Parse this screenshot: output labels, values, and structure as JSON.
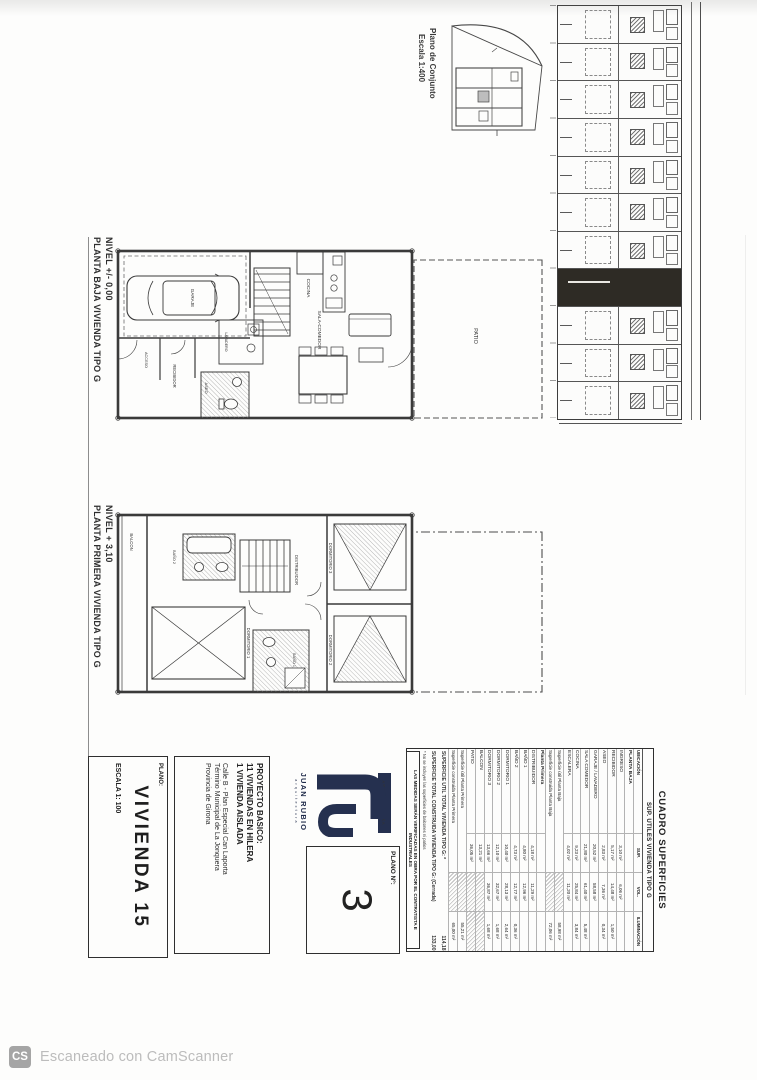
{
  "scan": {
    "footer_badge": "CS",
    "footer_text": "Escaneado con CamScanner"
  },
  "site_overview": {
    "caption_line1": "Plano de Conjunto",
    "caption_line2": "Escala 1:400"
  },
  "site_strip": {
    "unit_count": 11,
    "highlighted_unit_index": 7
  },
  "plans": [
    {
      "caption_line1": "NIVEL +/- 0,00",
      "caption_line2": "PLANTA BAJA VIVIENDA TIPO G",
      "labels": {
        "patio": "PATIO",
        "garaje": "GARAJE",
        "lavadero": "LAVADERO",
        "cocina": "COCINA",
        "sala_comedor": "SALA-COMEDOR",
        "aseo": "ASEO",
        "recibidor": "RECIBIDOR",
        "acceso": "ACCESO"
      }
    },
    {
      "caption_line1": "NIVEL + 3,10",
      "caption_line2": "PLANTA PRIMERA VIVIENDA TIPO G",
      "labels": {
        "balcon": "BALCON",
        "dormitorio1": "DORMITORIO 1",
        "dormitorio2": "DORMITORIO 2",
        "dormitorio3": "DORMITORIO 3",
        "bano1": "BAÑO 1",
        "bano2": "BAÑO 2",
        "distribuidor": "DISTRIBUIDOR"
      }
    }
  ],
  "title_block": {
    "logo": {
      "band": "ARQUITECTURA",
      "name": "JUAN RUBIO",
      "sub": "arquitectura"
    },
    "plano_num": {
      "label": "PLANO Nº:",
      "value": "3"
    },
    "project": {
      "heading": "PROYECTO BASICO:",
      "lines": [
        "11 VIVIENDAS EN HILERA",
        "1 VIVIENDA AISLADA"
      ],
      "address": [
        "Calle B - Plan Especial Can Laporta",
        "Término Municipal de La Jonquera",
        "Provincia de Girona"
      ]
    },
    "sheet": {
      "label": "PLANO:",
      "title": "VIVIENDA 15",
      "scale": "ESCALA 1: 100"
    }
  },
  "table": {
    "title": "CUADRO SUPERFICIES",
    "subtitle": "SUP. UTILES VIVIENDA TIPO G",
    "columns": [
      "UBICACIÓN",
      "SUP.",
      "VOL.",
      "ILUMINACIÓN"
    ],
    "sections": [
      {
        "name": "PLANTA BAJA",
        "rows": [
          [
            "INGRESO",
            "3,10 m²",
            "6,06 m²",
            ""
          ],
          [
            "RECIBIDOR",
            "5,17 m²",
            "14,48 m²",
            "1,50 m²"
          ],
          [
            "ASEO",
            "2,83 m²",
            "7,36 m²",
            "0,34 m²"
          ],
          [
            "GARAJE / LAVADERO",
            "20,52 m²",
            "58,58 m²",
            ""
          ],
          [
            "SALA COMEDOR",
            "21,80 m²",
            "61,40 m²",
            "5,48 m²"
          ],
          [
            "COCINA",
            "9,23 m²",
            "25,84 m²",
            "3,84 m²"
          ],
          [
            "ESCALERA",
            "4,02 m²",
            "11,20 m²",
            ""
          ]
        ],
        "totals": [
          [
            "Superficie útil Planta Baja",
            "58,98 m²"
          ],
          [
            "Superficie construida Planta Baja",
            "72,06 m²"
          ]
        ]
      },
      {
        "name": "Planta Primera",
        "rows": [
          [
            "DISTRIBUIDOR",
            "4,18 m²",
            "11,29 m²",
            ""
          ],
          [
            "BAÑO 1",
            "4,80 m²",
            "12,96 m²",
            ""
          ],
          [
            "BAÑO 2",
            "4,73 m²",
            "12,77 m²",
            "0,36 m²"
          ],
          [
            "DORMITORIO 1",
            "10,40 m²",
            "28,13 m²",
            "2,64 m²"
          ],
          [
            "DORMITORIO 2",
            "12,10 m²",
            "32,67 m²",
            "1,68 m²"
          ],
          [
            "DORMITORIO 3",
            "13,66 m²",
            "36,87 m²",
            "1,68 m²"
          ],
          [
            "BALCON",
            "13,21 m²",
            null,
            null
          ],
          [
            "PATIO",
            "36,05 m²",
            null,
            null
          ]
        ],
        "totals": [
          [
            "Superficie útil Planta Primera",
            "55,21 m²"
          ],
          [
            "Superficie construida Planta Primera",
            "65,00 m²"
          ]
        ]
      }
    ],
    "grand_totals": [
      [
        "SUPERFICIE UTIL TOTAL VIVIENDA TIPO G: *",
        "114,18 m²"
      ],
      [
        "SUPERFICIE TOTAL CONSTRUIDA VIVIENDA TIPO G: (Cerrada)",
        "133,00 m²"
      ]
    ],
    "footnote": "* No se incluyen las superficies de balcones ni patios",
    "disclaimer": "LAS MEDIDAS SERÁN VERIFICADAS EN OBRA POR EL CONTRATISTA E INDUSTRIALES"
  },
  "colors": {
    "logo_navy": "#25304f",
    "highlight_unit": "#2e2b25",
    "ink": "#3a3a3a"
  }
}
